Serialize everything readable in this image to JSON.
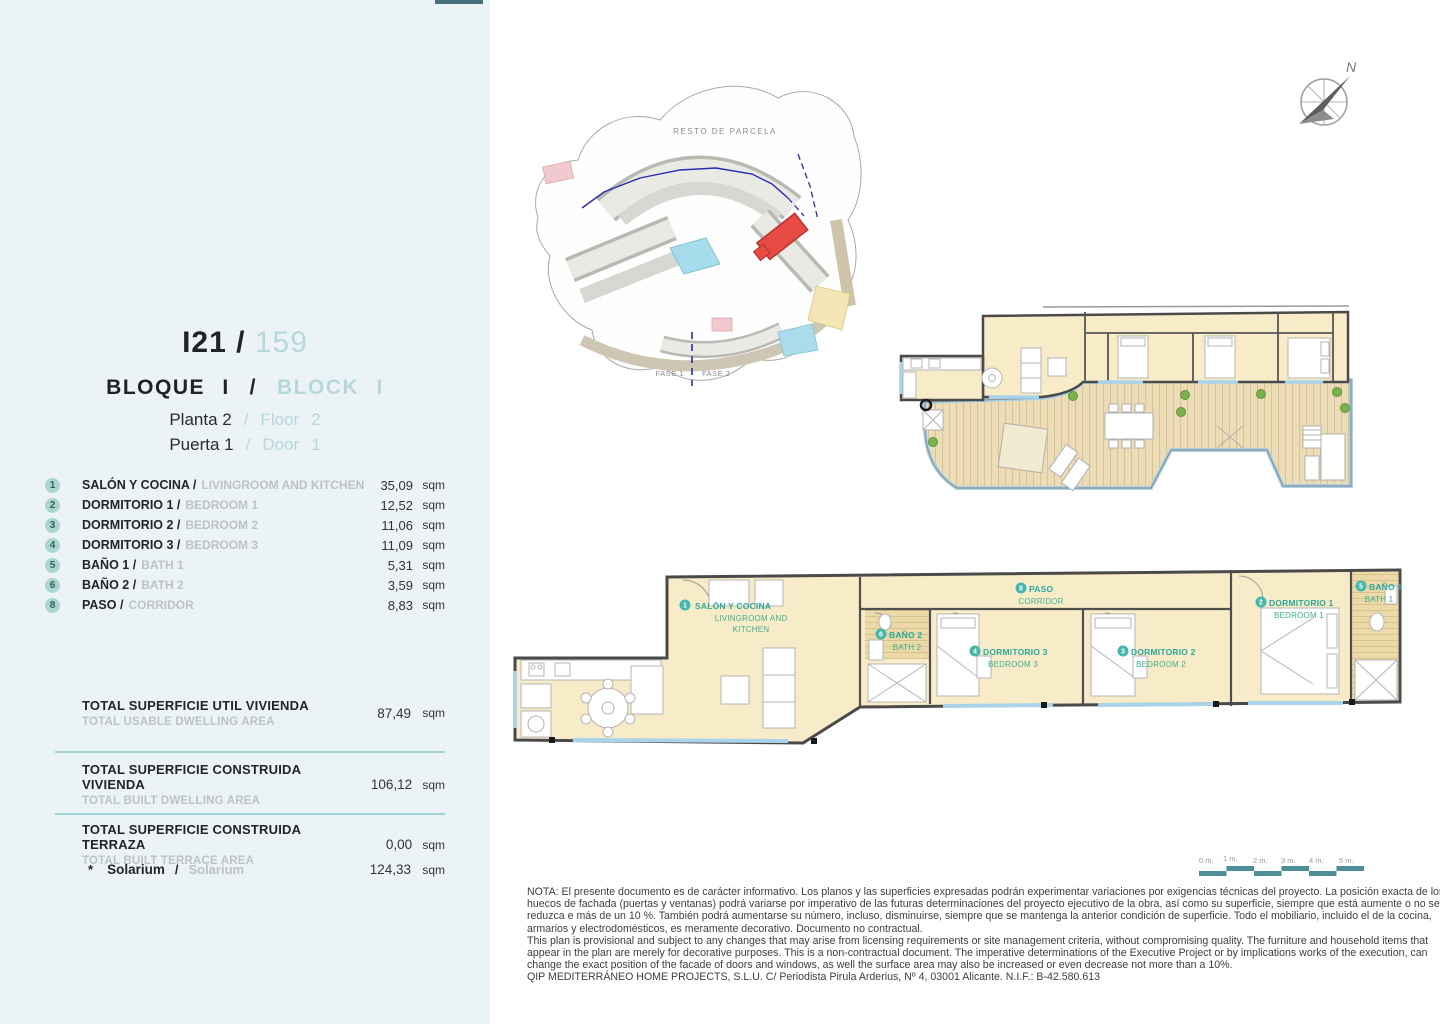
{
  "colors": {
    "panel_bg": "#ecf3f7",
    "accent_teal": "#9fd4d4",
    "light_teal_text": "#b7d8da",
    "badge_teal": "#a9d6cf",
    "muted_gray": "#bcc2c5",
    "dark_text": "#242424",
    "plan_label_teal": "#2ba89e",
    "plan_label_green": "#3fae92",
    "floor_cream": "#f8ecc8",
    "deck_wood": "#ecddb8",
    "window_blue": "#a9d3ea",
    "highlight_red": "#e84b44"
  },
  "unit": {
    "code": "I21",
    "separator": "/",
    "number": "159",
    "block_es": "BLOQUE I",
    "block_slash": "/",
    "block_en": "BLOCK I",
    "floor_es": "Planta 2",
    "floor_slash": "/",
    "floor_en": "Floor",
    "floor_value": "2",
    "door_es": "Puerta 1",
    "door_slash": "/",
    "door_en": "Door",
    "door_value": "1"
  },
  "rooms": [
    {
      "num": "1",
      "es": "SALÓN Y COCINA /",
      "en": "LIVINGROOM AND KITCHEN",
      "area": "35,09",
      "unit": "sqm"
    },
    {
      "num": "2",
      "es": "DORMITORIO 1 /",
      "en": "BEDROOM 1",
      "area": "12,52",
      "unit": "sqm"
    },
    {
      "num": "3",
      "es": "DORMITORIO 2 /",
      "en": "BEDROOM 2",
      "area": "11,06",
      "unit": "sqm"
    },
    {
      "num": "4",
      "es": "DORMITORIO 3 /",
      "en": "BEDROOM 3",
      "area": "11,09",
      "unit": "sqm"
    },
    {
      "num": "5",
      "es": "BAÑO 1 /",
      "en": "BATH 1",
      "area": "5,31",
      "unit": "sqm"
    },
    {
      "num": "6",
      "es": "BAÑO 2 /",
      "en": "BATH 2",
      "area": "3,59",
      "unit": "sqm"
    },
    {
      "num": "8",
      "es": "PASO /",
      "en": "CORRIDOR",
      "area": "8,83",
      "unit": "sqm"
    }
  ],
  "totals": [
    {
      "es": "TOTAL SUPERFICIE UTIL VIVIENDA",
      "en": "TOTAL USABLE DWELLING AREA",
      "value": "87,49",
      "unit": "sqm"
    },
    {
      "es": "TOTAL SUPERFICIE CONSTRUIDA VIVIENDA",
      "en": "TOTAL BUILT DWELLING AREA",
      "value": "106,12",
      "unit": "sqm"
    },
    {
      "es": "TOTAL SUPERFICIE CONSTRUIDA TERRAZA",
      "en": "TOTAL BUILT TERRACE AREA",
      "value": "0,00",
      "unit": "sqm"
    }
  ],
  "solarium": {
    "marker": "*",
    "es": "Solarium",
    "slash": "/",
    "en": "Solarium",
    "value": "124,33",
    "unit": "sqm"
  },
  "site_plan": {
    "area_label": "RESTO DE PARCELA",
    "phase1": "FASE 1",
    "phase2": "FASE 2"
  },
  "compass": {
    "north": "N"
  },
  "plan_labels": [
    {
      "num": "1",
      "es": "SALÓN Y COCINA",
      "en1": "LIVINGROOM AND",
      "en2": "KITCHEN"
    },
    {
      "num": "6",
      "es": "BAÑO 2",
      "en1": "BATH 2"
    },
    {
      "num": "4",
      "es": "DORMITORIO 3",
      "en1": "BEDROOM 3"
    },
    {
      "num": "8",
      "es": "PASO",
      "en1": "CORRIDOR"
    },
    {
      "num": "3",
      "es": "DORMITORIO 2",
      "en1": "BEDROOM 2"
    },
    {
      "num": "2",
      "es": "DORMITORIO 1",
      "en1": "BEDROOM 1"
    },
    {
      "num": "5",
      "es": "BAÑO 1",
      "en1": "BATH 1"
    }
  ],
  "scale_bar": {
    "ticks": [
      "0 m.",
      "1 m.",
      "2 m.",
      "3 m.",
      "4 m.",
      "5 m."
    ]
  },
  "notes": {
    "lines": [
      "NOTA: El presente documento es de carácter informativo. Los planos y las superficies expresadas podrán experimentar variaciones por exigencias técnicas del proyecto. La posición exacta de los",
      "huecos de fachada (puertas y ventanas) podrá variarse por imperativo de las futuras determinaciones del proyecto ejecutivo de la obra, así como su superficie, siempre que está aumente o no se",
      "reduzca e más de un 10 %. También podrá aumentarse su número, incluso, disminuirse, siempre que se mantenga la anterior condición de superficie. Todo el mobiliario, incluido el de la cocina,",
      "armarios y electrodomésticos, es meramente decorativo. Documento no contractual.",
      "This plan is provisional and subject to any changes that may arise from licensing requirements or site management criteria, without compromising quality. The furniture and household items that",
      "appear in the plan are merely for decorative purposes. This is a non-contractual document. The imperative determinations of the Executive Project or by implications works of the execution, can",
      "change the exact position of the facade of doors and windows, as well the surface area may also be increased or even decrease not more than a 10%.",
      "QIP MEDITERRÁNEO HOME PROJECTS, S.L.U. C/ Periodista Pirula Arderius, Nº 4, 03001 Alicante. N.I.F.: B-42.580.613"
    ]
  }
}
